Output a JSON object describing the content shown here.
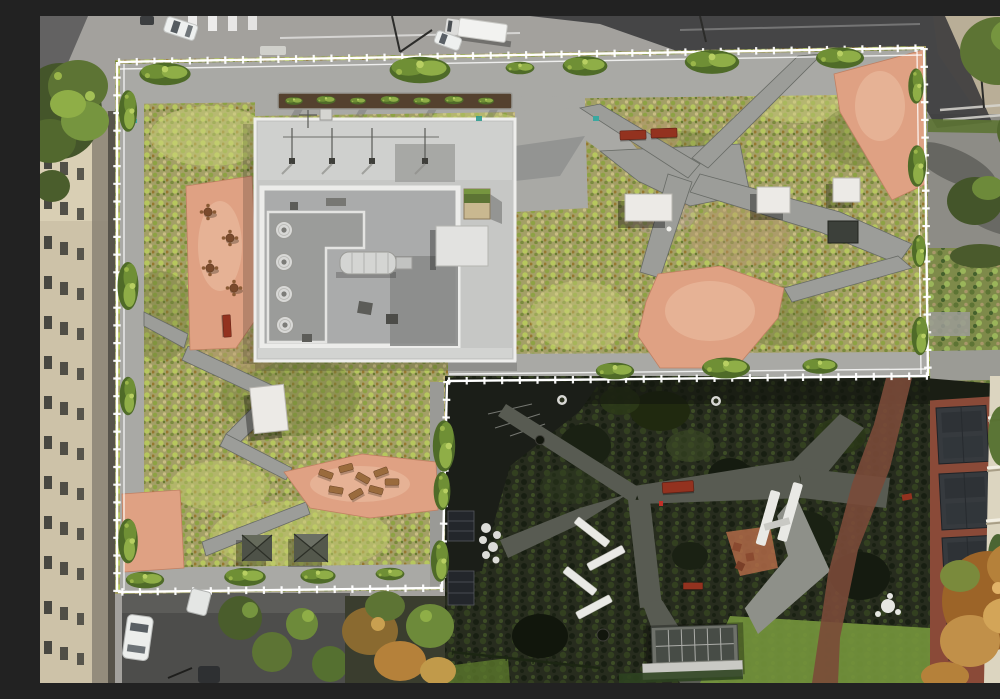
{
  "meta": {
    "type": "aerial-drone-photograph",
    "viewpoint": "top-down (nadir)",
    "dimensions": {
      "width_px": 1000,
      "height_px": 667
    }
  },
  "scene": {
    "title": "Top-down aerial photograph of an L-shaped building with an extensive green roof, salmon-coloured roof terraces, a white perimeter guard railing, and a shaded inner courtyard garden",
    "setting": "urban block in bright daylight, hard shadows cast toward lower left",
    "regions": [
      {
        "name": "green-roof",
        "description": "sedum and wildflower planting in yellow-greens, olives and tan soil, crossed by grey concrete paths"
      },
      {
        "name": "roof-terraces",
        "description": "salmon/terracotta paved terraces with cafe tables, wooden loungers and red benches"
      },
      {
        "name": "mechanical-penthouse",
        "description": "white rooftop core with parapet walls, round ventilation fans, silver duct, antenna masts and a small green-roofed hut"
      },
      {
        "name": "courtyard-garden",
        "description": "shaded ground-level garden with dark planting, lawns, forking grey paths, white angled benches, a brick path and a glass skylight structure"
      },
      {
        "name": "streets",
        "description": "asphalt streets at top and bottom-left with lane markings, crosswalks, street lamps, parked vehicles and trees"
      },
      {
        "name": "neighbouring-buildings",
        "description": "beige high-rise facade on the left, red-brick building with dark bay windows at lower right, cream building edge with climbing plants and balconies on the far right"
      }
    ],
    "objects": {
      "vehicles": [
        "white box truck (top street)",
        "white car beside truck (top street)",
        "white SUV (top-left street)",
        "dark car (top-left street)",
        "white car at kerb (top street)",
        "white car (bottom-left street)",
        "white van (bottom-left street)",
        "dark car (bottom-left street)"
      ],
      "roof_furniture": [
        "pair of red benches",
        "single red bench on upper terrace",
        "4 cafe table sets with chairs",
        "8 wooden loungers"
      ],
      "courtyard_furniture": [
        "2 white chevron benches",
        "2 white straight benches",
        "white round table cluster",
        "dark-red benches",
        "terracotta stools on planting island",
        "round planters"
      ],
      "roof_structures": [
        "4 white skylight boxes",
        "2 dark pyramid skylights",
        "dark vent box",
        "green-roofed hut on penthouse",
        "linear planter bed with shrubs",
        "glass greenhouse skylight in courtyard"
      ]
    },
    "lighting": "strong sunlight from the upper right; long diagonal building shadow across the top street; courtyard largely in shade with a sunlit lawn wedge at bottom"
  },
  "palette": {
    "street-light": "#a3a19d",
    "street-shadow": "#38383a",
    "asphalt-dark": "#4d4d4b",
    "sidewalk-tan": "#b9ae97",
    "pavement-gray": "#8d8c86",
    "beige-wall": "#cdc2a8",
    "window-dark": "#3a3a35",
    "roof-veg-base": "#a39f66",
    "walk-light": "#a9a9a5",
    "path-gray": "#9c9d99",
    "path-edge": "#686b66",
    "coral": "#dfa183",
    "coral-light": "#eec3a8",
    "core-wall": "#c6c7c5",
    "core-white": "#eeeeec",
    "core-floor": "#aaabab",
    "rail-white": "#ffffff",
    "bench-red": "#93321f",
    "hedge-dark": "#4f6b28",
    "hedge-mid": "#6f8f35",
    "hedge-light": "#8fae47",
    "court-base": "#272c1e",
    "court-lawn": "#76963c",
    "court-path": "#585b52",
    "court-path-sun": "#8e9089",
    "brick-red": "#8a4a38",
    "slate-dark": "#363a3e",
    "cream-wall": "#dcd5c0",
    "ivy-green": "#2e4420",
    "tree-green": "#5d7434",
    "tree-orange": "#b5813a",
    "white-furniture": "#e9e9e5",
    "glass-dark": "#474c46"
  }
}
